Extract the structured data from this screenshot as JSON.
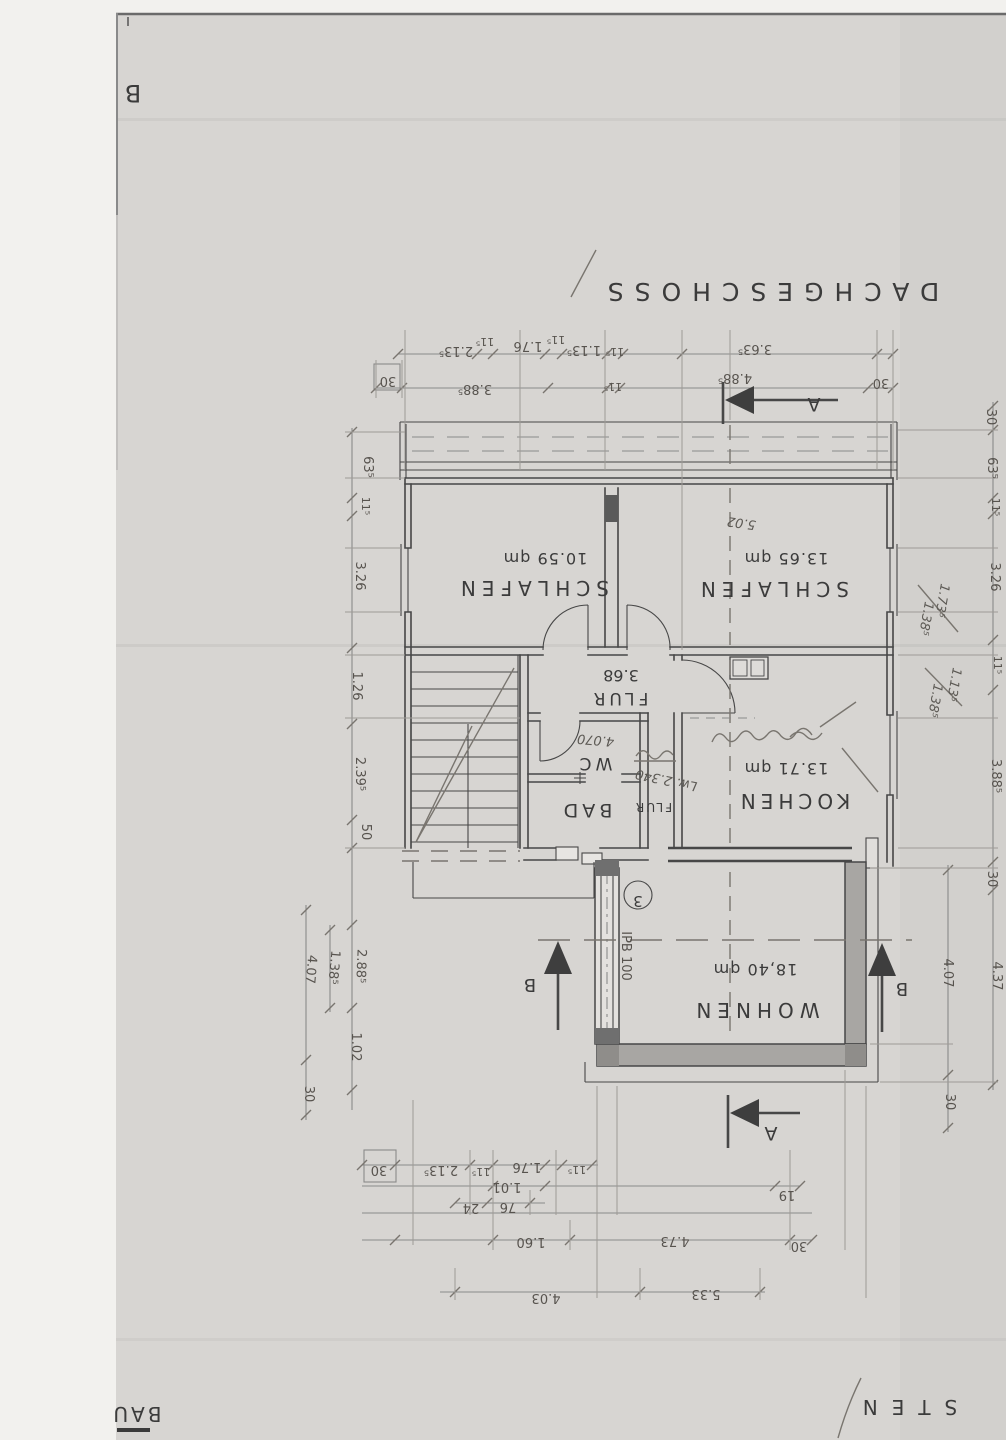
{
  "scan": {
    "corner_letter": "B",
    "title": "DACHGESCHOSS",
    "footer_left": "BAU",
    "footer_right": "STEN"
  },
  "rooms": {
    "schlafen_left": {
      "name": "SCHLAFEN",
      "area": "10.59 qm"
    },
    "schlafen_right": {
      "name": "SCHLAFEN",
      "area": "13.65 qm",
      "note": "5.02"
    },
    "flur": {
      "name": "FLUR",
      "area": "3.68"
    },
    "wc": {
      "name": "WC",
      "note": "4.070"
    },
    "bad": {
      "name": "BAD"
    },
    "flur_small": {
      "name": "FLUR",
      "note": "Lw. 2.340"
    },
    "kochen": {
      "name": "KOCHEN",
      "area": "13.71 qm"
    },
    "wohnen": {
      "name": "WOHNEN",
      "area": "18,40 qm"
    }
  },
  "markers": {
    "section_a": "A",
    "section_b": "B",
    "detail_circle": "3",
    "beam": "IPB 100"
  },
  "dims": {
    "top_inner": [
      "2.13⁵",
      "11⁵",
      "1.76",
      "11⁵",
      "1.13⁵",
      "11⁵",
      "3.63⁵"
    ],
    "top_outer": [
      "30",
      "3.88⁵",
      "11⁵",
      "4.88⁵",
      "30"
    ],
    "left_upper": [
      "63⁵",
      "11⁵",
      "3.26",
      "1.26",
      "2.39⁵",
      "50"
    ],
    "left_lower": [
      "2.88⁵",
      "1.38⁵",
      "4.07",
      "1.02",
      "30"
    ],
    "right_upper": [
      "30",
      "63⁵",
      "11⁵",
      "3.26",
      "11⁵",
      "3.88⁵",
      "30"
    ],
    "right_notes": [
      "1.73⁵",
      "1.38⁵",
      "1.13⁵",
      "1.38⁵"
    ],
    "right_lower": [
      "4.37",
      "4.07",
      "30"
    ],
    "bottom_row1": [
      "30",
      "2.13⁵",
      "11⁵",
      "1.76",
      "11⁵"
    ],
    "bottom_row2": [
      "1.01",
      "24",
      "76",
      "19"
    ],
    "bottom_row3": [
      "1.60",
      "4.73",
      "30"
    ],
    "bottom_row4": [
      "4.03",
      "5.33"
    ]
  }
}
